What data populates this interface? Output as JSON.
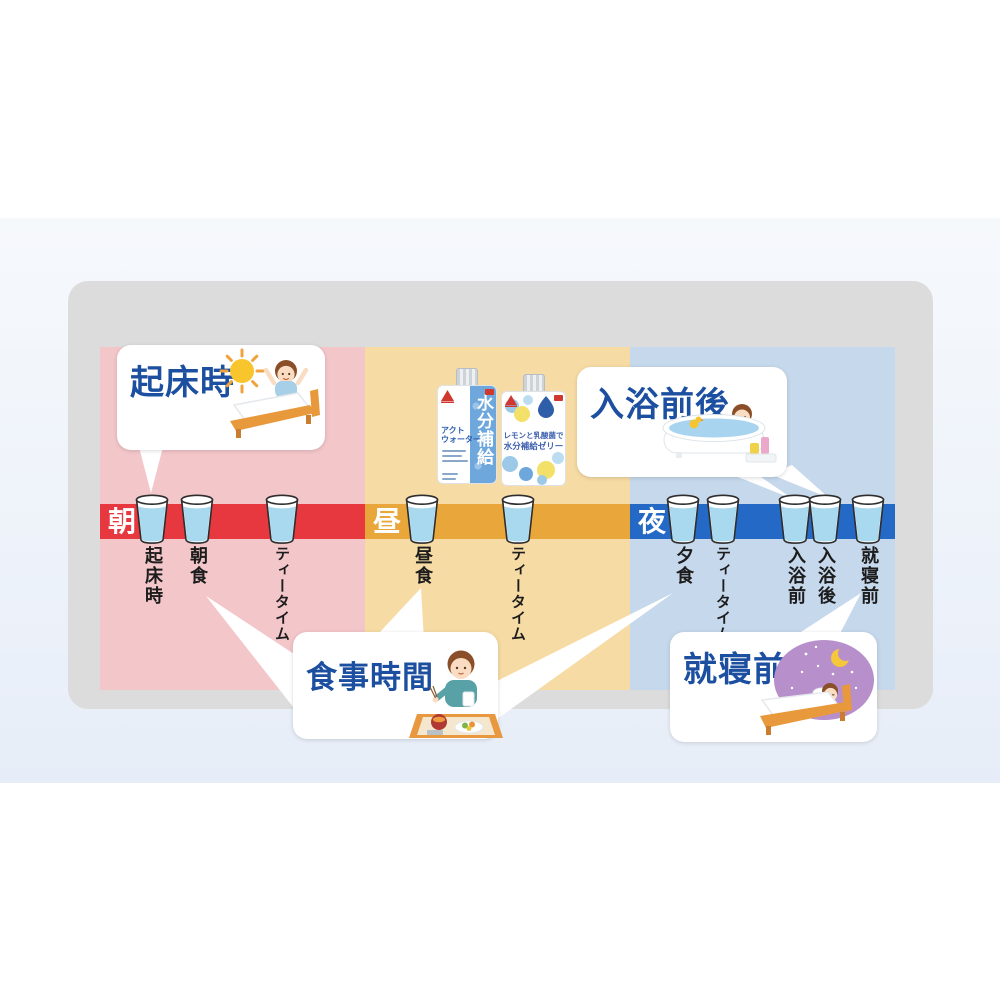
{
  "timeline": {
    "sections": [
      {
        "label": "朝",
        "bar_color": "#e8383f",
        "column_color": "#f3c6ca",
        "items": [
          {
            "label": "起床時"
          },
          {
            "label": "朝食"
          },
          {
            "label": "ティータイム"
          }
        ]
      },
      {
        "label": "昼",
        "bar_color": "#e9a63a",
        "column_color": "#f6dba4",
        "items": [
          {
            "label": "昼食"
          },
          {
            "label": "ティータイム"
          }
        ]
      },
      {
        "label": "夜",
        "bar_color": "#2569c6",
        "column_color": "#c6d8eb",
        "items": [
          {
            "label": "夕食"
          },
          {
            "label": "ティータイム"
          },
          {
            "label": "入浴前"
          },
          {
            "label": "入浴後"
          },
          {
            "label": "就寝前"
          }
        ]
      }
    ]
  },
  "bubbles": {
    "wake": {
      "title": "起床時",
      "illustration": "boy-waking-in-bed-with-sun"
    },
    "bath": {
      "title": "入浴前後",
      "illustration": "boy-in-bathtub-with-duck"
    },
    "meal": {
      "title": "食事時間",
      "illustration": "boy-eating-meal-on-tray"
    },
    "sleep": {
      "title": "就寝前",
      "illustration": "boy-sleeping-under-night-sky"
    }
  },
  "products": {
    "act_water": {
      "name_line1": "アクト",
      "name_line2": "ウォーター",
      "vertical_label": "水分補給"
    },
    "lemon_jelly": {
      "line1": "レモンと乳酸菌で",
      "line2": "水分補給ゼリー"
    }
  },
  "colors": {
    "morning_bar": "#e8383f",
    "noon_bar": "#e9a63a",
    "night_bar": "#2569c6",
    "morning_column": "#f3c6ca",
    "noon_column": "#f6dba4",
    "night_column": "#c6d8eb",
    "panel": "#dcdcdc",
    "title_text": "#1c4fa0",
    "water": "#a9d9ef"
  }
}
